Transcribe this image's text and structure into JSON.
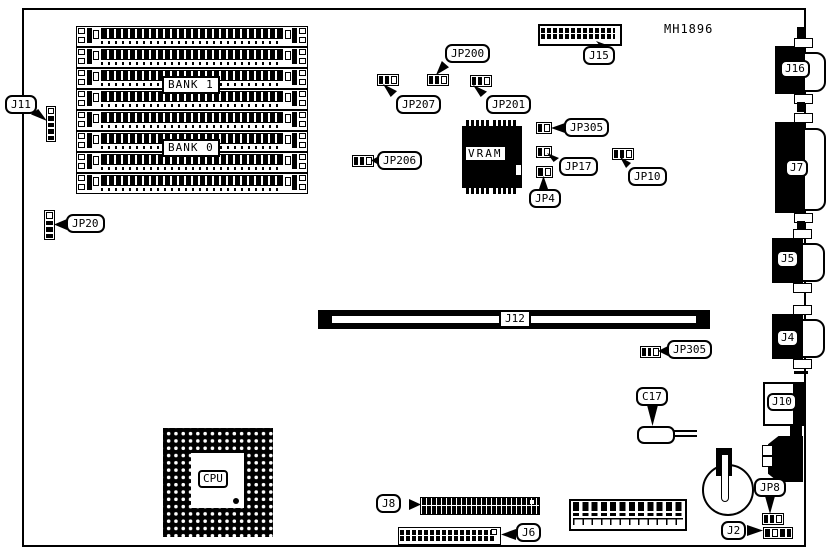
{
  "diagram": {
    "part_number": "MH1896",
    "memory": {
      "bank1_label": "BANK 1",
      "bank0_label": "BANK 0",
      "simm_slot_count": 8
    },
    "chips": {
      "cpu_label": "CPU",
      "vram_label": "VRAM"
    },
    "slot": {
      "j12_label": "J12"
    },
    "connectors": {
      "j15": "J15",
      "j16": "J16",
      "j7": "J7",
      "j5": "J5",
      "j4": "J4",
      "j10": "J10",
      "j11": "J11",
      "j8": "J8",
      "j6": "J6",
      "j2": "J2"
    },
    "jumpers": {
      "jp20": "JP20",
      "jp200": "JP200",
      "jp207": "JP207",
      "jp201": "JP201",
      "jp206": "JP206",
      "jp305_top": "JP305",
      "jp305_mid": "JP305",
      "jp17": "JP17",
      "jp4": "JP4",
      "jp10": "JP10",
      "jp8": "JP8"
    },
    "capacitors": {
      "c17": "C17"
    }
  }
}
